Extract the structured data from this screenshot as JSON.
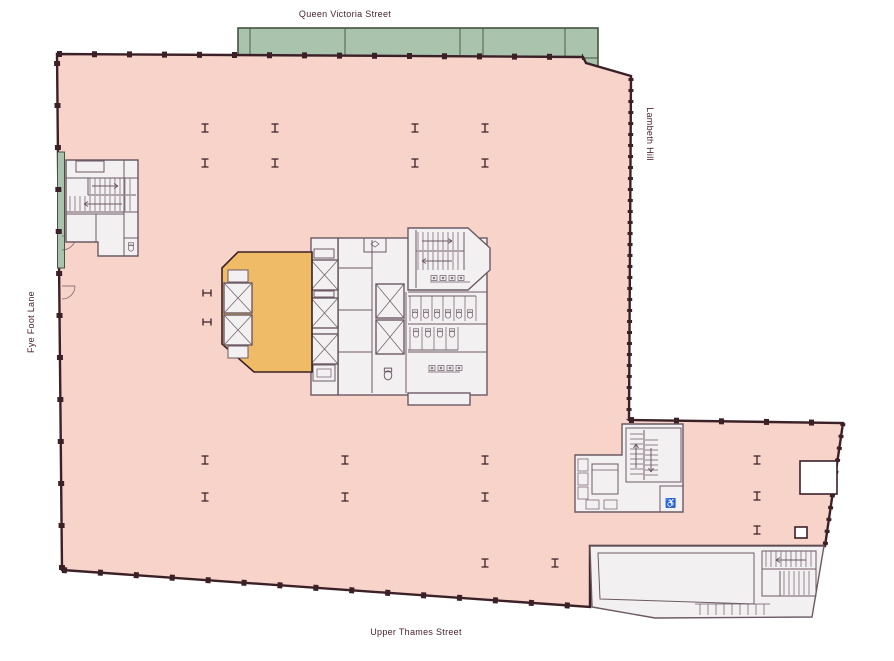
{
  "labels": {
    "top_street": "Queen Victoria Street",
    "bottom_street": "Upper Thames Street",
    "left_street": "Fye Foot Lane",
    "right_street": "Lambeth Hill"
  },
  "icons": {
    "accessible_wc": "♿"
  },
  "colors": {
    "floor_pink": "#f7d3c9",
    "highlight_orange": "#f0bb67",
    "walkway_green": "#a9c3ac",
    "walkway_green_dark": "#44543f",
    "wall_dark": "#3b2127",
    "core_fill": "#f3f0f2",
    "core_line": "#6b5a64",
    "label_text": "#4a2330",
    "background": "#ffffff"
  }
}
